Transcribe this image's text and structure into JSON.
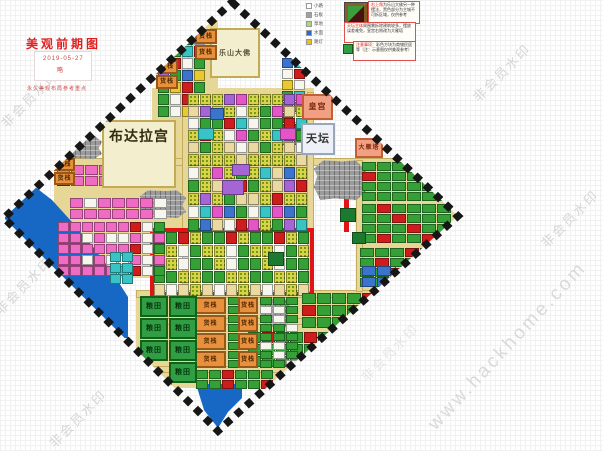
{
  "page": {
    "watermark_text": "非会员水印",
    "site_watermark": "www.hackhome.com"
  },
  "title": {
    "heading": "美观前期图",
    "date": "2019-05-27",
    "note": "略",
    "caption": "永久美观布局参考重点"
  },
  "legend": {
    "items": [
      {
        "color": "#ffffff",
        "label": "小路"
      },
      {
        "color": "#a0a0a0",
        "label": "石板"
      },
      {
        "color": "#a8d878",
        "label": "草地"
      },
      {
        "color": "#3068c8",
        "label": "水面"
      },
      {
        "color": "#e8c020",
        "label": "路灯"
      }
    ],
    "thumb_name": "mini-map-thumbnail",
    "notes": [
      {
        "lead": "右上角",
        "text": "为乐山大佛另一种摆法，黑色部分为主城不可拆区域，仅供参考"
      },
      {
        "lead": "天坛主体",
        "text": "周围需拆除建筑较多，摆放误差难免，皇宫右侧改为大雁塔"
      },
      {
        "lead": "注意事项：",
        "text": "彩色方块为商铺民居等（注：示意图仅供美观参考）"
      }
    ]
  },
  "map": {
    "diamond_points": "232,2 458,216 218,431 4,218",
    "colors": {
      "road": "#e7d796",
      "water": "#1668c4",
      "mountain": "#9b9b9b",
      "red_road": "#e01414",
      "building_beige": "#f3eecd",
      "warehouse": "#e8903c",
      "field_green": "#2f9e44",
      "residential_green": "#35a035"
    },
    "rects": [
      {
        "n": "base-left-district",
        "x": 54,
        "y": 160,
        "w": 112,
        "h": 118,
        "bg": "#e7d796"
      },
      {
        "n": "base-top-shops",
        "x": 156,
        "y": 20,
        "w": 62,
        "h": 102,
        "bg": "#e7d796"
      },
      {
        "n": "base-center-district",
        "x": 152,
        "y": 88,
        "w": 162,
        "h": 144,
        "bg": "#e7d796"
      },
      {
        "n": "base-bottom-district",
        "x": 136,
        "y": 294,
        "w": 165,
        "h": 94,
        "bg": "#e7d796"
      },
      {
        "n": "base-bottomright-district",
        "x": 298,
        "y": 290,
        "w": 152,
        "h": 100,
        "bg": "#e7d796"
      },
      {
        "n": "base-right-district",
        "x": 358,
        "y": 158,
        "w": 100,
        "h": 136,
        "bg": "#e7d796"
      },
      {
        "n": "road-h-main",
        "x": 60,
        "y": 158,
        "w": 392,
        "h": 8,
        "bg": "#e7d796",
        "bd": "1px solid #c4ad5e"
      },
      {
        "n": "road-h-2",
        "x": 136,
        "y": 290,
        "w": 306,
        "h": 8,
        "bg": "#e7d796",
        "bd": "1px solid #c4ad5e"
      },
      {
        "n": "road-h-3",
        "x": 140,
        "y": 318,
        "w": 292,
        "h": 7,
        "bg": "#e7d796",
        "bd": "1px solid #c4ad5e"
      },
      {
        "n": "road-h-4",
        "x": 150,
        "y": 366,
        "w": 252,
        "h": 7,
        "bg": "#e7d796",
        "bd": "1px solid #c4ad5e"
      },
      {
        "n": "road-v-1",
        "x": 182,
        "y": 28,
        "w": 7,
        "h": 262,
        "bg": "#e7d796",
        "bd": "1px solid #c4ad5e"
      },
      {
        "n": "road-v-2",
        "x": 307,
        "y": 92,
        "w": 7,
        "h": 200,
        "bg": "#e7d796",
        "bd": "1px solid #c4ad5e"
      },
      {
        "n": "road-v-3",
        "x": 356,
        "y": 160,
        "w": 7,
        "h": 132,
        "bg": "#e7d796",
        "bd": "1px solid #c4ad5e"
      },
      {
        "n": "red-road-segment",
        "x": 344,
        "y": 178,
        "w": 5,
        "h": 54,
        "bg": "#e01414"
      },
      {
        "n": "red-road-loop",
        "x": 150,
        "y": 228,
        "w": 164,
        "h": 68,
        "bg": "transparent",
        "bd": "4px solid #e01414"
      }
    ],
    "polys": [
      {
        "n": "lake-west",
        "bg": "#1668c4",
        "pts": "30,183 52,200 72,222 94,248 114,275 128,297 128,338 5,338 5,200"
      },
      {
        "n": "lake-south",
        "bg": "#1668c4",
        "pts": "196,384 242,384 242,398 228,412 218,428 204,410"
      }
    ],
    "mountains": [
      {
        "n": "mountain-1",
        "x": 60,
        "y": 135,
        "w": 42,
        "h": 24
      },
      {
        "n": "mountain-2",
        "x": 140,
        "y": 190,
        "w": 46,
        "h": 28
      },
      {
        "n": "mountain-3",
        "x": 314,
        "y": 160,
        "w": 52,
        "h": 40
      },
      {
        "n": "mountain-4",
        "x": 260,
        "y": 298,
        "w": 30,
        "h": 30
      }
    ],
    "grids": [
      {
        "n": "grid-top-shops",
        "x": 158,
        "y": 22,
        "c": 4,
        "r": 8,
        "w": 11,
        "h": 11,
        "pal": [
          "#cf1d1d",
          "#35a035",
          "#3a74cc",
          "#f6f6ef",
          "#38c4c4",
          "#e9c832",
          "#35a035",
          "#cf1d1d",
          "#a565d5",
          "#f6f6ef",
          "#3a74cc",
          "#35a035"
        ]
      },
      {
        "n": "grid-topright-shops",
        "x": 282,
        "y": 58,
        "c": 2,
        "r": 8,
        "w": 11,
        "h": 10,
        "pal": [
          "#3a74cc",
          "#cf1d1d",
          "#e9c832",
          "#38c4c4",
          "#35a035",
          "#f6f6ef",
          "#cf1d1d",
          "#35a035"
        ]
      },
      {
        "n": "grid-center-north",
        "x": 188,
        "y": 94,
        "c": 10,
        "r": 5,
        "w": 11,
        "h": 11,
        "pal": [
          "F",
          "#35a035",
          "#f6f6ef",
          "F",
          "#cf1d1d",
          "#ead9a0",
          "F",
          "#38c4c4",
          "#35a035",
          "#a565d5",
          "#f6f6ef",
          "F",
          "#e456c8",
          "#35a035",
          "#ead9a0"
        ]
      },
      {
        "n": "grid-center-south",
        "x": 188,
        "y": 154,
        "c": 10,
        "r": 6,
        "w": 11,
        "h": 12,
        "pal": [
          "F",
          "#ead9a0",
          "#35a035",
          "F",
          "#a565d5",
          "#f6f6ef",
          "F",
          "#cf1d1d",
          "#38c4c4",
          "F",
          "#35a035",
          "#e456c8",
          "#ead9a0",
          "F",
          "#3a74cc"
        ]
      },
      {
        "n": "grid-inner-loop",
        "x": 154,
        "y": 232,
        "c": 13,
        "r": 5,
        "w": 11,
        "h": 12,
        "pal": [
          "#35a035",
          "F",
          "#ead9a0",
          "#35a035",
          "#f6f6ef",
          "F",
          "#cf1d1d",
          "#35a035",
          "#ead9a0",
          "F",
          "#35a035",
          "#f6f6ef"
        ]
      },
      {
        "n": "grid-west-pink-1",
        "x": 57,
        "y": 165,
        "c": 8,
        "r": 2,
        "w": 13,
        "h": 10,
        "pal": [
          "#f06cc4",
          "#f06cc4",
          "#f6f6ef",
          "#f06cc4",
          "#f06cc4",
          "#cf1d1d",
          "#f06cc4",
          "#f06cc4"
        ]
      },
      {
        "n": "grid-west-pink-2",
        "x": 70,
        "y": 198,
        "c": 7,
        "r": 2,
        "w": 13,
        "h": 10,
        "pal": [
          "#f06cc4",
          "#f06cc4",
          "#f06cc4",
          "#f6f6ef",
          "#f06cc4"
        ]
      },
      {
        "n": "grid-west-small",
        "x": 58,
        "y": 222,
        "c": 9,
        "r": 5,
        "w": 11,
        "h": 10,
        "pal": [
          "#f06cc4",
          "#f6f6ef",
          "#f06cc4",
          "#f06cc4",
          "#35a035",
          "#f06cc4",
          "#f06cc4",
          "#f6f6ef",
          "#cf1d1d",
          "#f06cc4"
        ]
      },
      {
        "n": "grid-west-cyan",
        "x": 110,
        "y": 252,
        "c": 2,
        "r": 3,
        "w": 11,
        "h": 10,
        "pal": [
          "#38c4c4"
        ]
      },
      {
        "n": "grid-east-res-1",
        "x": 362,
        "y": 162,
        "c": 6,
        "r": 4,
        "w": 14,
        "h": 9,
        "pal": [
          "#35a035",
          "#35a035",
          "#35a035",
          "#35a035",
          "#35a035",
          "#cf1d1d",
          "#35a035",
          "#35a035",
          "#35a035"
        ]
      },
      {
        "n": "grid-east-res-2",
        "x": 362,
        "y": 204,
        "c": 6,
        "r": 4,
        "w": 14,
        "h": 9,
        "pal": [
          "#35a035",
          "#35a035",
          "#35a035",
          "#cf1d1d",
          "#35a035",
          "#35a035",
          "#35a035",
          "#35a035"
        ]
      },
      {
        "n": "grid-east-res-3",
        "x": 360,
        "y": 248,
        "c": 6,
        "r": 4,
        "w": 14,
        "h": 9,
        "pal": [
          "#35a035",
          "#35a035",
          "#cf1d1d",
          "#35a035",
          "#35a035",
          "#35a035",
          "#35a035"
        ]
      },
      {
        "n": "grid-east-blue",
        "x": 362,
        "y": 266,
        "c": 2,
        "r": 2,
        "w": 14,
        "h": 10,
        "pal": [
          "#3a74cc"
        ]
      },
      {
        "n": "grid-southeast-res-1",
        "x": 302,
        "y": 293,
        "c": 8,
        "r": 3,
        "w": 14,
        "h": 11,
        "pal": [
          "#35a035",
          "#35a035",
          "#35a035",
          "#35a035",
          "#35a035",
          "#cf1d1d",
          "#35a035"
        ]
      },
      {
        "n": "grid-southeast-res-2",
        "x": 248,
        "y": 332,
        "c": 12,
        "r": 3,
        "w": 13,
        "h": 11,
        "pal": [
          "#35a035",
          "#35a035",
          "#35a035",
          "#cf1d1d",
          "#35a035",
          "#35a035",
          "#35a035",
          "#35a035",
          "#35a035"
        ]
      },
      {
        "n": "grid-bottom-green-1",
        "x": 228,
        "y": 297,
        "c": 1,
        "r": 8,
        "w": 11,
        "h": 8,
        "pal": [
          "#35a035"
        ]
      },
      {
        "n": "grid-bottom-green-2",
        "x": 260,
        "y": 297,
        "c": 3,
        "r": 8,
        "w": 12,
        "h": 8,
        "pal": [
          "#35a035",
          "#f6f6ef",
          "#35a035",
          "#35a035"
        ]
      },
      {
        "n": "grid-bottom-last",
        "x": 196,
        "y": 370,
        "c": 6,
        "r": 2,
        "w": 12,
        "h": 9,
        "pal": [
          "#35a035",
          "#cf1d1d",
          "#35a035",
          "#35a035",
          "#35a035"
        ]
      }
    ],
    "deco": [
      {
        "n": "deco-purple-1",
        "x": 222,
        "y": 180,
        "w": 22,
        "h": 15,
        "bg": "#a565d5"
      },
      {
        "n": "deco-purple-2",
        "x": 232,
        "y": 164,
        "w": 18,
        "h": 12,
        "bg": "#a565d5"
      },
      {
        "n": "deco-purple-3",
        "x": 150,
        "y": 150,
        "w": 16,
        "h": 12,
        "bg": "#a565d5"
      },
      {
        "n": "deco-magenta-1",
        "x": 280,
        "y": 128,
        "w": 16,
        "h": 12,
        "bg": "#e456c8"
      },
      {
        "n": "deco-cyan-1",
        "x": 198,
        "y": 128,
        "w": 16,
        "h": 12,
        "bg": "#38c4c4"
      },
      {
        "n": "deco-blue-1",
        "x": 210,
        "y": 108,
        "w": 14,
        "h": 12,
        "bg": "#3a74cc"
      },
      {
        "n": "deco-darkgreen-1",
        "x": 268,
        "y": 252,
        "w": 16,
        "h": 14,
        "bg": "#1c7a30"
      },
      {
        "n": "deco-darkgreen-2",
        "x": 340,
        "y": 208,
        "w": 16,
        "h": 14,
        "bg": "#1c7a30"
      },
      {
        "n": "deco-darkgreen-3",
        "x": 352,
        "y": 232,
        "w": 14,
        "h": 12,
        "bg": "#1c7a30"
      },
      {
        "n": "deco-brown-1",
        "x": 240,
        "y": 352,
        "w": 16,
        "h": 12,
        "bg": "#8a5a2a"
      }
    ],
    "buildings": [
      {
        "n": "building-potala-palace",
        "t": "布达拉宫",
        "x": 102,
        "y": 120,
        "w": 74,
        "h": 68,
        "bg": "#f3eecd",
        "bd": "#c3ab55",
        "fs": 14,
        "fc": "#332d10",
        "va": "top"
      },
      {
        "n": "building-leshan-buddha",
        "t": "乐山大佛",
        "x": 210,
        "y": 28,
        "w": 50,
        "h": 50,
        "bg": "#f3eecd",
        "bd": "#c3ab55",
        "fs": 7,
        "fc": "#55503a",
        "va": "mid"
      },
      {
        "n": "building-imperial-palace",
        "t": "皇宫",
        "x": 302,
        "y": 94,
        "w": 31,
        "h": 26,
        "bg": "#f2a083",
        "bd": "#c25f33",
        "fs": 8,
        "fc": "#7a2a10",
        "va": "mid"
      },
      {
        "n": "building-temple-of-heaven",
        "t": "天坛",
        "x": 301,
        "y": 123,
        "w": 34,
        "h": 32,
        "bg": "#eef2f8",
        "bd": "#9aa7b8",
        "fs": 11,
        "fc": "#333333",
        "va": "mid"
      },
      {
        "n": "building-giant-wild-goose-pagoda",
        "t": "大雁塔",
        "x": 355,
        "y": 138,
        "w": 28,
        "h": 20,
        "bg": "#f2a083",
        "bd": "#c25f33",
        "fs": 6,
        "fc": "#7a2a10",
        "va": "mid"
      },
      {
        "n": "warehouse",
        "t": "货栈",
        "x": 195,
        "y": 29,
        "w": 22,
        "h": 15,
        "bg": "#e8903c",
        "bd": "#99571a",
        "fs": 6,
        "fc": "#4a2804",
        "va": "mid"
      },
      {
        "n": "warehouse",
        "t": "货栈",
        "x": 195,
        "y": 45,
        "w": 22,
        "h": 15,
        "bg": "#e8903c",
        "bd": "#99571a",
        "fs": 6,
        "fc": "#4a2804",
        "va": "mid"
      },
      {
        "n": "warehouse",
        "t": "货栈",
        "x": 156,
        "y": 60,
        "w": 22,
        "h": 14,
        "bg": "#e8903c",
        "bd": "#99571a",
        "fs": 6,
        "fc": "#4a2804",
        "va": "mid"
      },
      {
        "n": "warehouse",
        "t": "货栈",
        "x": 156,
        "y": 75,
        "w": 22,
        "h": 14,
        "bg": "#e8903c",
        "bd": "#99571a",
        "fs": 6,
        "fc": "#4a2804",
        "va": "mid"
      },
      {
        "n": "warehouse",
        "t": "货栈",
        "x": 54,
        "y": 158,
        "w": 21,
        "h": 13,
        "bg": "#e8903c",
        "bd": "#99571a",
        "fs": 6,
        "fc": "#4a2804",
        "va": "mid"
      },
      {
        "n": "warehouse",
        "t": "货栈",
        "x": 54,
        "y": 172,
        "w": 21,
        "h": 13,
        "bg": "#e8903c",
        "bd": "#99571a",
        "fs": 6,
        "fc": "#4a2804",
        "va": "mid"
      },
      {
        "n": "warehouse",
        "t": "货栈",
        "x": 195,
        "y": 297,
        "w": 31,
        "h": 17,
        "bg": "#e8903c",
        "bd": "#99571a",
        "fs": 6,
        "fc": "#4a2804",
        "va": "mid"
      },
      {
        "n": "warehouse",
        "t": "货栈",
        "x": 195,
        "y": 315,
        "w": 31,
        "h": 17,
        "bg": "#e8903c",
        "bd": "#99571a",
        "fs": 6,
        "fc": "#4a2804",
        "va": "mid"
      },
      {
        "n": "warehouse",
        "t": "货栈",
        "x": 195,
        "y": 333,
        "w": 31,
        "h": 17,
        "bg": "#e8903c",
        "bd": "#99571a",
        "fs": 6,
        "fc": "#4a2804",
        "va": "mid"
      },
      {
        "n": "warehouse",
        "t": "货栈",
        "x": 195,
        "y": 351,
        "w": 31,
        "h": 17,
        "bg": "#e8903c",
        "bd": "#99571a",
        "fs": 6,
        "fc": "#4a2804",
        "va": "mid"
      },
      {
        "n": "warehouse",
        "t": "货栈",
        "x": 238,
        "y": 297,
        "w": 20,
        "h": 17,
        "bg": "#e8903c",
        "bd": "#99571a",
        "fs": 6,
        "fc": "#4a2804",
        "va": "mid"
      },
      {
        "n": "warehouse",
        "t": "货栈",
        "x": 238,
        "y": 315,
        "w": 20,
        "h": 17,
        "bg": "#e8903c",
        "bd": "#99571a",
        "fs": 6,
        "fc": "#4a2804",
        "va": "mid"
      },
      {
        "n": "warehouse",
        "t": "货栈",
        "x": 238,
        "y": 333,
        "w": 20,
        "h": 17,
        "bg": "#e8903c",
        "bd": "#99571a",
        "fs": 6,
        "fc": "#4a2804",
        "va": "mid"
      },
      {
        "n": "warehouse",
        "t": "货栈",
        "x": 238,
        "y": 351,
        "w": 20,
        "h": 17,
        "bg": "#e8903c",
        "bd": "#99571a",
        "fs": 6,
        "fc": "#4a2804",
        "va": "mid"
      },
      {
        "n": "warehouse",
        "t": "货栈",
        "x": 147,
        "y": 380,
        "w": 25,
        "h": 12,
        "bg": "#e8903c",
        "bd": "#99571a",
        "fs": 6,
        "fc": "#4a2804",
        "va": "mid"
      },
      {
        "n": "grain-field",
        "t": "粮田",
        "x": 140,
        "y": 296,
        "w": 28,
        "h": 21,
        "bg": "#2f9e44",
        "bd": "#156015",
        "fs": 7,
        "fc": "#06350b",
        "va": "mid"
      },
      {
        "n": "grain-field",
        "t": "粮田",
        "x": 169,
        "y": 296,
        "w": 28,
        "h": 21,
        "bg": "#2f9e44",
        "bd": "#156015",
        "fs": 7,
        "fc": "#06350b",
        "va": "mid"
      },
      {
        "n": "grain-field",
        "t": "粮田",
        "x": 140,
        "y": 318,
        "w": 28,
        "h": 21,
        "bg": "#2f9e44",
        "bd": "#156015",
        "fs": 7,
        "fc": "#06350b",
        "va": "mid"
      },
      {
        "n": "grain-field",
        "t": "粮田",
        "x": 169,
        "y": 318,
        "w": 28,
        "h": 21,
        "bg": "#2f9e44",
        "bd": "#156015",
        "fs": 7,
        "fc": "#06350b",
        "va": "mid"
      },
      {
        "n": "grain-field",
        "t": "粮田",
        "x": 140,
        "y": 340,
        "w": 28,
        "h": 21,
        "bg": "#2f9e44",
        "bd": "#156015",
        "fs": 7,
        "fc": "#06350b",
        "va": "mid"
      },
      {
        "n": "grain-field",
        "t": "粮田",
        "x": 169,
        "y": 340,
        "w": 28,
        "h": 21,
        "bg": "#2f9e44",
        "bd": "#156015",
        "fs": 7,
        "fc": "#06350b",
        "va": "mid"
      },
      {
        "n": "grain-field",
        "t": "粮田",
        "x": 169,
        "y": 362,
        "w": 28,
        "h": 21,
        "bg": "#2f9e44",
        "bd": "#156015",
        "fs": 7,
        "fc": "#06350b",
        "va": "mid"
      }
    ]
  }
}
